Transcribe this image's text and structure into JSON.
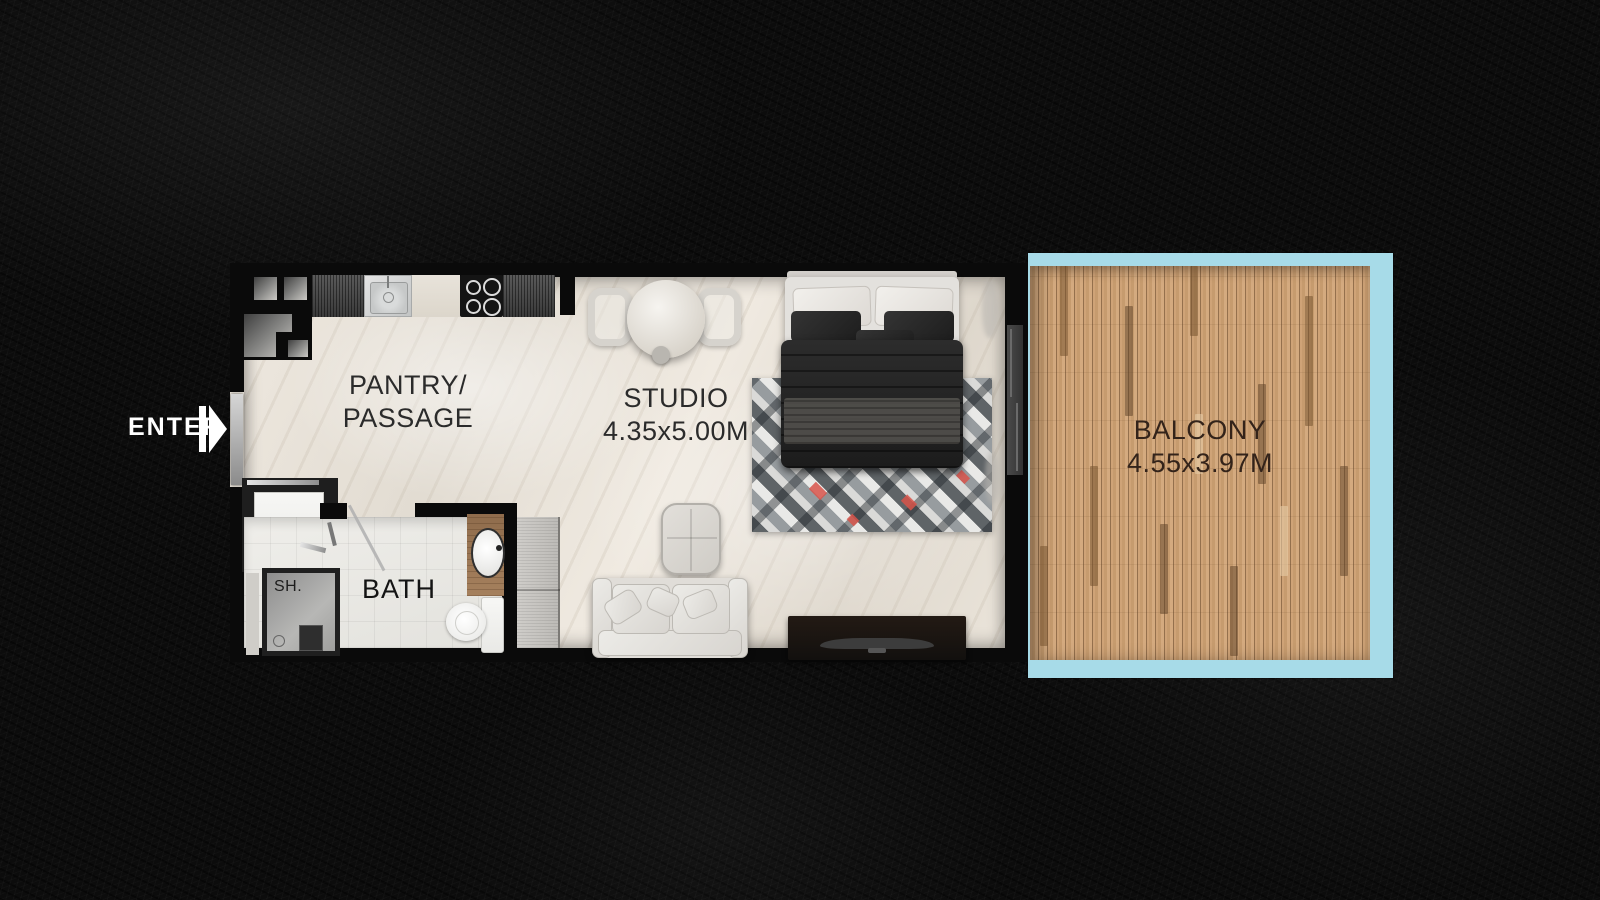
{
  "plan": {
    "title": "Studio apartment floor plan",
    "entry": {
      "label": "ENTER"
    },
    "rooms": {
      "pantry_passage": {
        "label_line1": "PANTRY/",
        "label_line2": "PASSAGE"
      },
      "studio": {
        "label": "STUDIO",
        "dimensions": "4.35x5.00M"
      },
      "bath": {
        "label": "BATH"
      },
      "shower": {
        "label": "SH."
      },
      "balcony": {
        "label": "BALCONY",
        "dimensions": "4.55x3.97M"
      }
    },
    "colors": {
      "background": "#0c0c0c",
      "walls": "#0a0a0a",
      "floor": "#e8e2d9",
      "bath_floor": "#eceae6",
      "balcony_frame": "#a7dbe8",
      "balcony_deck": "#c99f74",
      "room_label_text": "#2b2b2b",
      "enter_text": "#ffffff"
    }
  }
}
